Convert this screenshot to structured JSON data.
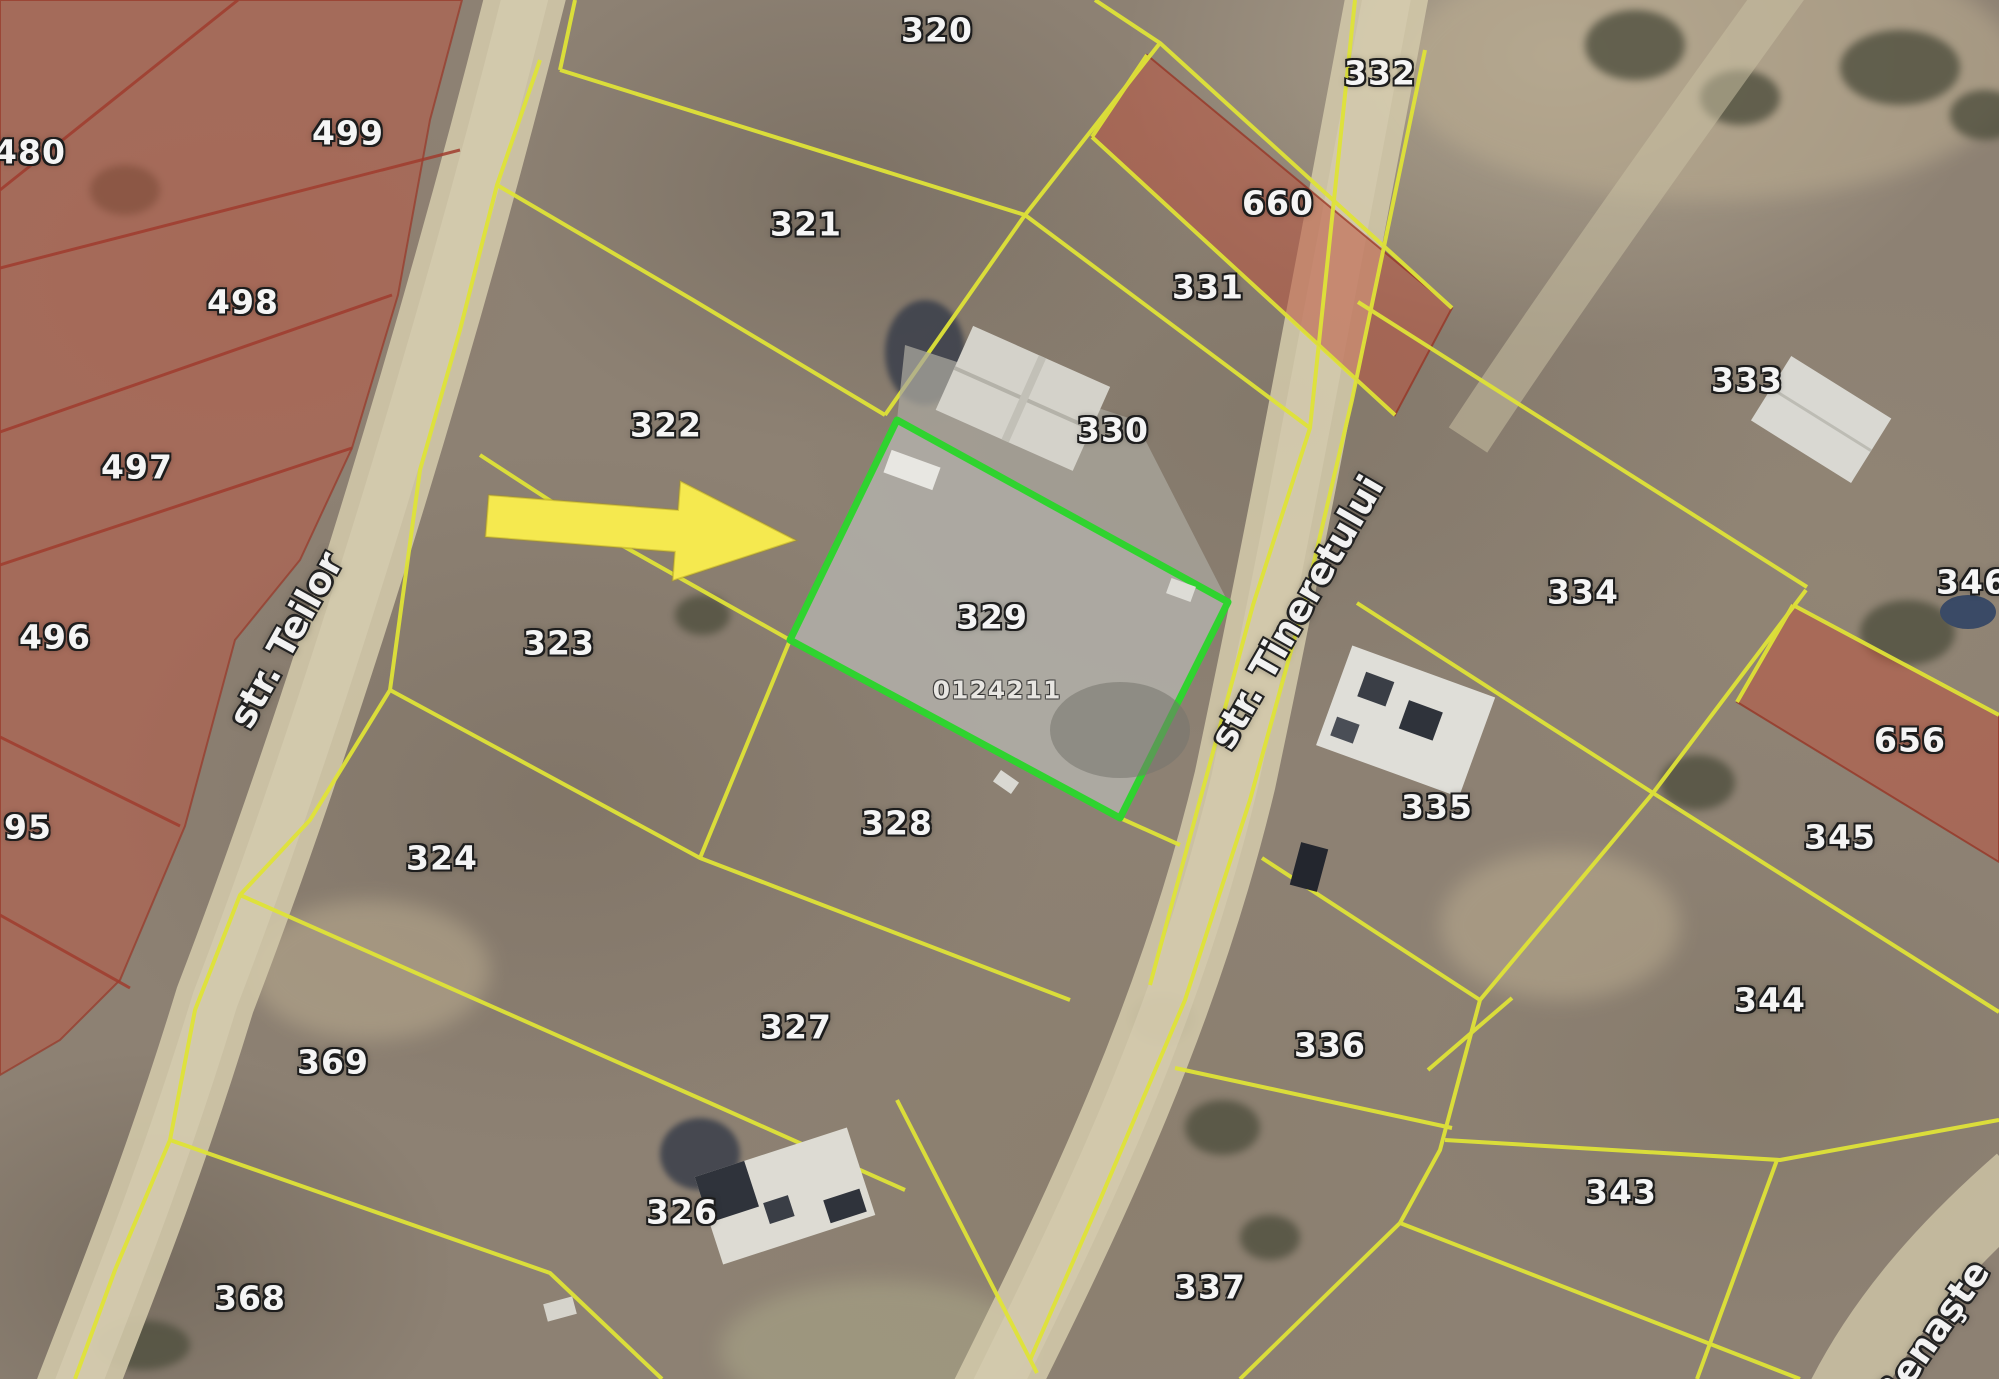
{
  "map": {
    "type": "cadastral-satellite-view",
    "selected_parcel": {
      "number": "329",
      "cadastral_code": "0124211",
      "outline_color": "#2fd32f"
    },
    "streets": [
      {
        "name": "str. Teilor",
        "x": 286,
        "y": 640,
        "angle": -61
      },
      {
        "name": "str. Tineretului",
        "x": 1297,
        "y": 612,
        "angle": -60
      },
      {
        "name": "Renaşte",
        "x": 1932,
        "y": 1334,
        "angle": -55
      }
    ],
    "parcels": [
      {
        "number": "480",
        "x": 30,
        "y": 152
      },
      {
        "number": "499",
        "x": 348,
        "y": 133
      },
      {
        "number": "498",
        "x": 243,
        "y": 302
      },
      {
        "number": "497",
        "x": 137,
        "y": 467
      },
      {
        "number": "496",
        "x": 55,
        "y": 637
      },
      {
        "number": "95",
        "x": 28,
        "y": 827
      },
      {
        "number": "320",
        "x": 937,
        "y": 30
      },
      {
        "number": "321",
        "x": 806,
        "y": 224
      },
      {
        "number": "322",
        "x": 666,
        "y": 425
      },
      {
        "number": "323",
        "x": 559,
        "y": 643
      },
      {
        "number": "324",
        "x": 442,
        "y": 858
      },
      {
        "number": "369",
        "x": 333,
        "y": 1062
      },
      {
        "number": "368",
        "x": 250,
        "y": 1298
      },
      {
        "number": "326",
        "x": 682,
        "y": 1212
      },
      {
        "number": "327",
        "x": 796,
        "y": 1027
      },
      {
        "number": "328",
        "x": 897,
        "y": 823
      },
      {
        "number": "329",
        "x": 992,
        "y": 617,
        "selected": true
      },
      {
        "number": "330",
        "x": 1113,
        "y": 430
      },
      {
        "number": "331",
        "x": 1208,
        "y": 287
      },
      {
        "number": "332",
        "x": 1380,
        "y": 73
      },
      {
        "number": "660",
        "x": 1278,
        "y": 203
      },
      {
        "number": "333",
        "x": 1747,
        "y": 380
      },
      {
        "number": "334",
        "x": 1583,
        "y": 592
      },
      {
        "number": "335",
        "x": 1437,
        "y": 807
      },
      {
        "number": "336",
        "x": 1330,
        "y": 1045
      },
      {
        "number": "337",
        "x": 1210,
        "y": 1287
      },
      {
        "number": "343",
        "x": 1621,
        "y": 1192
      },
      {
        "number": "344",
        "x": 1770,
        "y": 1000
      },
      {
        "number": "345",
        "x": 1840,
        "y": 837
      },
      {
        "number": "346",
        "x": 1972,
        "y": 582
      },
      {
        "number": "656",
        "x": 1910,
        "y": 740
      }
    ],
    "red_highlighted_parcels": [
      "480",
      "499",
      "498",
      "497",
      "496",
      "95",
      "660",
      "656"
    ],
    "colors": {
      "boundary_yellow": "#dfe338",
      "boundary_red": "#a03c2e",
      "red_parcel_fill": "rgba(188,86,66,0.5)",
      "highlight_green": "#2fd32f",
      "arrow_yellow": "#f5e94f",
      "road_beige": "#cfc5a7"
    }
  }
}
